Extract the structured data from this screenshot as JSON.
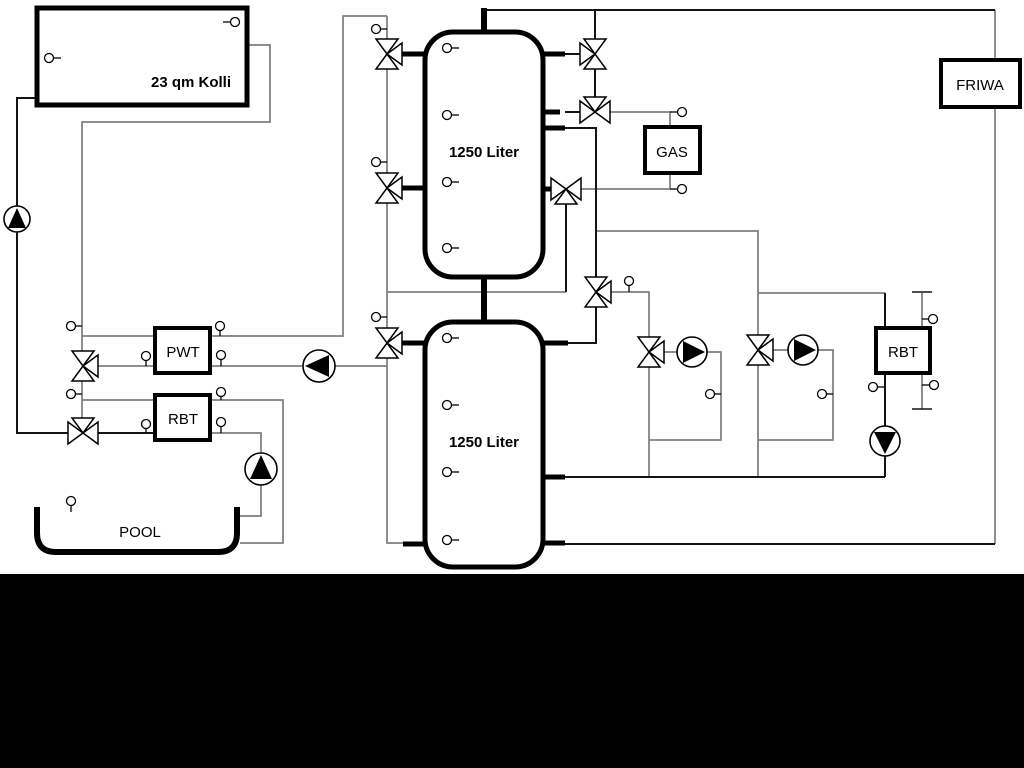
{
  "diagram": {
    "title_labels": {
      "collector": "23 qm Kolli",
      "tank1": "1250 Liter",
      "tank2": "1250 Liter",
      "gas": "GAS",
      "friwa": "FRIWA",
      "pwt": "PWT",
      "rbt_left": "RBT",
      "rbt_right": "RBT",
      "pool": "POOL"
    },
    "colors": {
      "pipe_gray": "#7f7f7f",
      "pipe_dark": "#141414",
      "outline": "#000000",
      "background": "#ffffff",
      "bottom_band": "#000000"
    }
  }
}
